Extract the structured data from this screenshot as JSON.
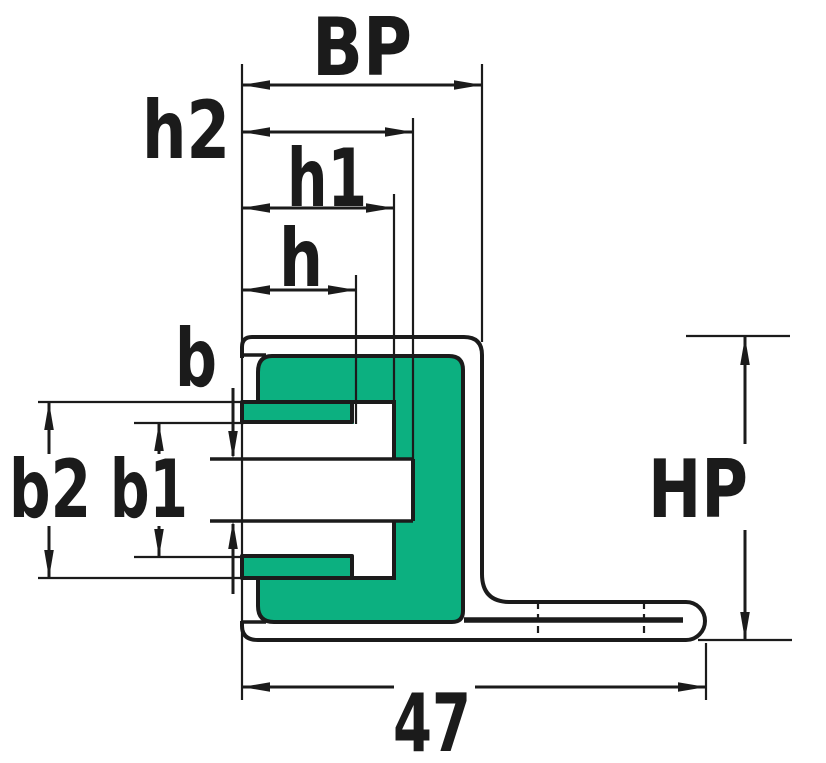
{
  "drawing": {
    "description": "Technical cross-section drawing of an L-shaped profile with green gasket insert and dimension annotations",
    "colors": {
      "gasket": "#0cb080",
      "line": "#1b1b1b",
      "background": "#ffffff"
    },
    "labels": {
      "bp": "BP",
      "h2": "h2",
      "h1": "h1",
      "h": "h",
      "b": "b",
      "b2": "b2",
      "b1": "b1",
      "hp": "HP",
      "overall_width": "47"
    }
  }
}
